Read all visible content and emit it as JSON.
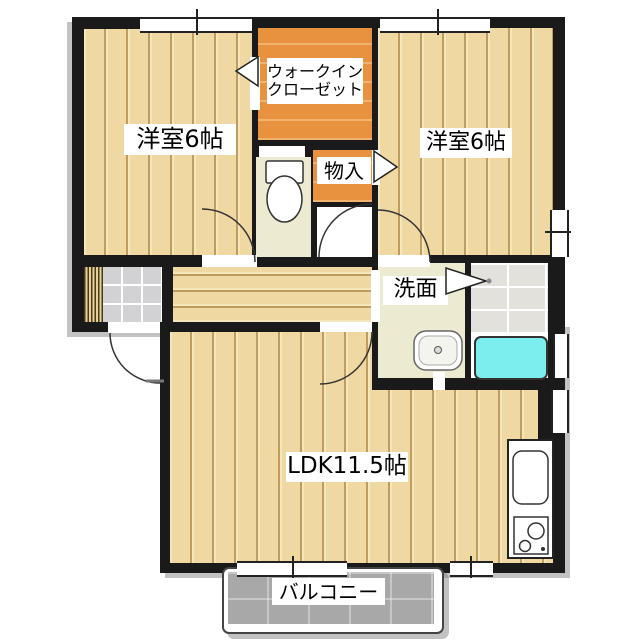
{
  "floorplan": {
    "title": "2LDK apartment floor plan",
    "rooms": {
      "bedroom_left": {
        "label": "洋室6帖"
      },
      "bedroom_right": {
        "label": "洋室6帖"
      },
      "walk_in_closet": {
        "label_line1": "ウォークイン",
        "label_line2": "クローゼット"
      },
      "storage": {
        "label": "物入"
      },
      "washroom": {
        "label": "洗面"
      },
      "ldk": {
        "label": "LDK11.5帖"
      },
      "balcony": {
        "label": "バルコニー"
      }
    },
    "fixtures": [
      "toilet",
      "washbasin",
      "bathtub",
      "kitchen-sink",
      "stove",
      "entrance-steps"
    ],
    "colors": {
      "wall": "#1a1a1a",
      "wood_floor": "#efd8a2",
      "wood_plank_line": "#d8b97c",
      "closet_orange": "#e8913e",
      "sanitary_cream": "#ecead0",
      "genkan_tile": "#d2d2d5",
      "bath_tile": "#e3e1db",
      "bathtub_cyan": "#7deeee",
      "balcony_gray": "#a8a8a8",
      "shadow": "#9a9a9a"
    }
  }
}
